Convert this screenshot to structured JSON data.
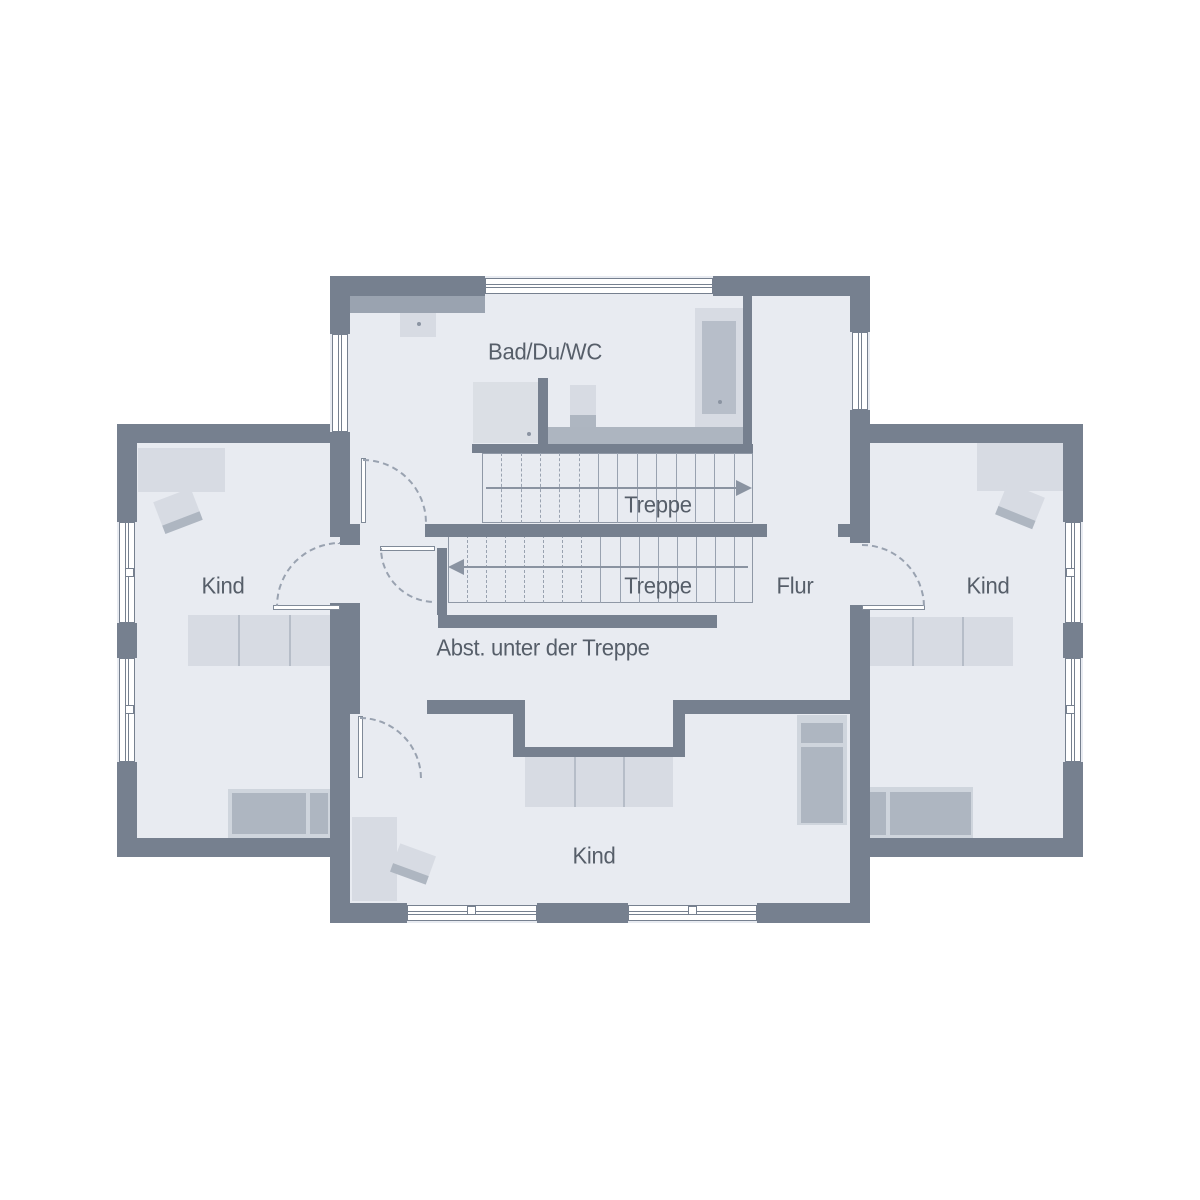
{
  "colors": {
    "wall": "#76808F",
    "floor": "#E8EBF1",
    "light": "#D7DBE3",
    "mid": "#AEB6C1",
    "lightmid": "#CFD5DD",
    "ledge": "#9AA3B0",
    "band": "#ADB5C0",
    "shower": "#DBDFE5",
    "tubinner": "#B7BEC9",
    "line": "#99A2B0",
    "accent": "#8A93A1",
    "text": "#565E69",
    "divider": "#B6BDC8"
  },
  "labels": [
    {
      "id": "bad",
      "text": "Bad/Du/WC",
      "x": 545,
      "y": 352
    },
    {
      "id": "treppe-upper",
      "text": "Treppe",
      "x": 658,
      "y": 505
    },
    {
      "id": "treppe-lower",
      "text": "Treppe",
      "x": 658,
      "y": 586
    },
    {
      "id": "flur",
      "text": "Flur",
      "x": 795,
      "y": 586
    },
    {
      "id": "kind-left",
      "text": "Kind",
      "x": 223,
      "y": 586
    },
    {
      "id": "kind-right",
      "text": "Kind",
      "x": 988,
      "y": 586
    },
    {
      "id": "kind-bottom",
      "text": "Kind",
      "x": 594,
      "y": 856
    },
    {
      "id": "abst",
      "text": "Abst. unter der Treppe",
      "x": 543,
      "y": 648
    }
  ],
  "floors": [
    {
      "n": "floor-center",
      "x": 330,
      "y": 276,
      "w": 540,
      "h": 647
    },
    {
      "n": "floor-left-wing",
      "x": 117,
      "y": 424,
      "w": 213,
      "h": 433
    },
    {
      "n": "floor-right-wing",
      "x": 870,
      "y": 424,
      "w": 213,
      "h": 433
    }
  ],
  "furniture": [
    {
      "n": "wardrobe-left",
      "x": 138,
      "y": 448,
      "w": 87,
      "h": 44,
      "c": "light"
    },
    {
      "n": "dresser-left",
      "x": 188,
      "y": 615,
      "w": 152,
      "h": 51,
      "c": "light"
    },
    {
      "n": "dresser-left-div-1",
      "x": 238,
      "y": 615,
      "w": 2,
      "h": 51,
      "c": "divider"
    },
    {
      "n": "dresser-left-div-2",
      "x": 289,
      "y": 615,
      "w": 2,
      "h": 51,
      "c": "divider"
    },
    {
      "n": "bed-left-base",
      "x": 228,
      "y": 789,
      "w": 104,
      "h": 49,
      "c": "lightmid"
    },
    {
      "n": "bed-left-mattress",
      "x": 232,
      "y": 793,
      "w": 74,
      "h": 41,
      "c": "mid"
    },
    {
      "n": "bed-left-pillow",
      "x": 310,
      "y": 793,
      "w": 18,
      "h": 41,
      "c": "mid"
    },
    {
      "n": "wardrobe-right",
      "x": 977,
      "y": 443,
      "w": 86,
      "h": 48,
      "c": "light"
    },
    {
      "n": "dresser-right",
      "x": 862,
      "y": 617,
      "w": 151,
      "h": 49,
      "c": "light"
    },
    {
      "n": "dresser-right-div-1",
      "x": 912,
      "y": 617,
      "w": 2,
      "h": 49,
      "c": "divider"
    },
    {
      "n": "dresser-right-div-2",
      "x": 962,
      "y": 617,
      "w": 2,
      "h": 49,
      "c": "divider"
    },
    {
      "n": "bed-right-base",
      "x": 860,
      "y": 787,
      "w": 113,
      "h": 51,
      "c": "lightmid"
    },
    {
      "n": "bed-right-pillow",
      "x": 864,
      "y": 792,
      "w": 22,
      "h": 43,
      "c": "mid"
    },
    {
      "n": "bed-right-mattress",
      "x": 890,
      "y": 792,
      "w": 81,
      "h": 43,
      "c": "mid"
    },
    {
      "n": "dresser-bottom",
      "x": 525,
      "y": 757,
      "w": 148,
      "h": 50,
      "c": "light"
    },
    {
      "n": "dresser-bottom-div-1",
      "x": 574,
      "y": 757,
      "w": 2,
      "h": 50,
      "c": "divider"
    },
    {
      "n": "dresser-bottom-div-2",
      "x": 623,
      "y": 757,
      "w": 2,
      "h": 50,
      "c": "divider"
    },
    {
      "n": "bed-bottom-base",
      "x": 797,
      "y": 715,
      "w": 50,
      "h": 110,
      "c": "lightmid"
    },
    {
      "n": "bed-bottom-pillow",
      "x": 801,
      "y": 723,
      "w": 42,
      "h": 20,
      "c": "mid"
    },
    {
      "n": "bed-bottom-mattress",
      "x": 801,
      "y": 747,
      "w": 42,
      "h": 76,
      "c": "mid"
    },
    {
      "n": "wardrobe-bottom",
      "x": 352,
      "y": 817,
      "w": 45,
      "h": 84,
      "c": "light"
    },
    {
      "n": "bath-ledge",
      "x": 350,
      "y": 296,
      "w": 135,
      "h": 17,
      "c": "ledge"
    },
    {
      "n": "sink",
      "x": 400,
      "y": 313,
      "w": 36,
      "h": 24,
      "c": "light"
    },
    {
      "n": "shower",
      "x": 473,
      "y": 382,
      "w": 65,
      "h": 61,
      "c": "shower"
    },
    {
      "n": "wc-tank",
      "x": 570,
      "y": 385,
      "w": 26,
      "h": 30,
      "c": "light"
    },
    {
      "n": "wc-base",
      "x": 570,
      "y": 415,
      "w": 26,
      "h": 13,
      "c": "mid"
    },
    {
      "n": "bathtub-surround",
      "x": 695,
      "y": 308,
      "w": 48,
      "h": 136,
      "c": "light"
    },
    {
      "n": "bathtub-inner",
      "x": 702,
      "y": 321,
      "w": 34,
      "h": 93,
      "c": "tubinner"
    },
    {
      "n": "bath-band",
      "x": 548,
      "y": 427,
      "w": 195,
      "h": 17,
      "c": "band"
    }
  ],
  "desks": [
    {
      "n": "desk-left",
      "x": 158,
      "y": 494,
      "w": 40,
      "h": 34,
      "rot": -21
    },
    {
      "n": "desk-right",
      "x": 1000,
      "y": 489,
      "w": 40,
      "h": 34,
      "rot": 22
    },
    {
      "n": "desk-bottom",
      "x": 394,
      "y": 849,
      "w": 38,
      "h": 30,
      "rot": 20
    }
  ],
  "walls": [
    [
      330,
      276,
      155,
      20
    ],
    [
      713,
      276,
      157,
      20
    ],
    [
      330,
      296,
      20,
      38
    ],
    [
      330,
      432,
      20,
      105
    ],
    [
      330,
      603,
      20,
      320
    ],
    [
      850,
      296,
      20,
      36
    ],
    [
      850,
      410,
      20,
      133
    ],
    [
      850,
      605,
      20,
      318
    ],
    [
      330,
      903,
      77,
      20
    ],
    [
      537,
      903,
      91,
      20
    ],
    [
      757,
      903,
      113,
      20
    ],
    [
      117,
      424,
      213,
      19
    ],
    [
      117,
      424,
      20,
      98
    ],
    [
      117,
      623,
      20,
      35
    ],
    [
      117,
      762,
      20,
      95
    ],
    [
      117,
      838,
      213,
      19
    ],
    [
      870,
      424,
      213,
      19
    ],
    [
      1063,
      424,
      20,
      98
    ],
    [
      1063,
      623,
      20,
      35
    ],
    [
      1063,
      762,
      20,
      95
    ],
    [
      870,
      838,
      213,
      19
    ],
    [
      472,
      444,
      281,
      9
    ],
    [
      743,
      296,
      9,
      148
    ],
    [
      538,
      378,
      10,
      66
    ],
    [
      425,
      524,
      342,
      13
    ],
    [
      838,
      524,
      12,
      13
    ],
    [
      340,
      524,
      20,
      21
    ],
    [
      437,
      548,
      10,
      67
    ],
    [
      438,
      615,
      279,
      13
    ],
    [
      340,
      603,
      20,
      111
    ],
    [
      427,
      700,
      98,
      14
    ],
    [
      673,
      700,
      177,
      14
    ],
    [
      513,
      700,
      12,
      57
    ],
    [
      673,
      700,
      12,
      57
    ],
    [
      513,
      747,
      172,
      10
    ]
  ],
  "windows": [
    {
      "n": "window-top",
      "x": 485,
      "y": 278,
      "w": 228,
      "h": 16,
      "o": "h",
      "handle": "none"
    },
    {
      "n": "window-bath-left",
      "x": 332,
      "y": 334,
      "w": 16,
      "h": 98,
      "o": "v",
      "handle": "none"
    },
    {
      "n": "window-flur-right",
      "x": 852,
      "y": 332,
      "w": 16,
      "h": 78,
      "o": "v",
      "handle": "none"
    },
    {
      "n": "window-bottom-1",
      "x": 407,
      "y": 905,
      "w": 130,
      "h": 16,
      "o": "h",
      "handle": "top"
    },
    {
      "n": "window-bottom-2",
      "x": 628,
      "y": 905,
      "w": 129,
      "h": 16,
      "o": "h",
      "handle": "top"
    },
    {
      "n": "window-left-wing-1",
      "x": 119,
      "y": 522,
      "w": 16,
      "h": 101,
      "o": "v",
      "handle": "right"
    },
    {
      "n": "window-left-wing-2",
      "x": 119,
      "y": 658,
      "w": 16,
      "h": 104,
      "o": "v",
      "handle": "right"
    },
    {
      "n": "window-right-wing-1",
      "x": 1065,
      "y": 522,
      "w": 16,
      "h": 101,
      "o": "v",
      "handle": "left"
    },
    {
      "n": "window-right-wing-2",
      "x": 1065,
      "y": 658,
      "w": 16,
      "h": 104,
      "o": "v",
      "handle": "left"
    }
  ],
  "doors": [
    {
      "n": "door-bath",
      "leaf": [
        361,
        458,
        5,
        65
      ],
      "box": [
        363,
        459,
        64
      ],
      "corner": "tr"
    },
    {
      "n": "door-abst",
      "leaf": [
        380,
        546,
        55,
        5
      ],
      "box": [
        380,
        548,
        55
      ],
      "corner": "bl"
    },
    {
      "n": "door-kind-left",
      "leaf": [
        273,
        605,
        67,
        5
      ],
      "box": [
        276,
        542,
        64
      ],
      "corner": "tl"
    },
    {
      "n": "door-kind-right",
      "leaf": [
        862,
        605,
        63,
        5
      ],
      "box": [
        862,
        544,
        63
      ],
      "corner": "tr"
    },
    {
      "n": "door-kind-bottom",
      "leaf": [
        358,
        716,
        5,
        62
      ],
      "box": [
        360,
        717,
        62
      ],
      "corner": "tr"
    }
  ],
  "stairs": [
    {
      "n": "stair-upper",
      "x": 482,
      "y": 453,
      "w": 271,
      "h": 70,
      "treads": [
        {
          "x": 501,
          "d": 1
        },
        {
          "x": 521,
          "d": 1
        },
        {
          "x": 540,
          "d": 1
        },
        {
          "x": 559,
          "d": 1
        },
        {
          "x": 579,
          "d": 1
        },
        {
          "x": 598,
          "d": 0
        },
        {
          "x": 617,
          "d": 0
        },
        {
          "x": 637,
          "d": 0
        },
        {
          "x": 656,
          "d": 0
        },
        {
          "x": 676,
          "d": 0
        },
        {
          "x": 695,
          "d": 0
        },
        {
          "x": 714,
          "d": 0
        },
        {
          "x": 734,
          "d": 0
        }
      ],
      "arrow": {
        "y": 488,
        "x1": 486,
        "x2": 736,
        "dir": "right"
      }
    },
    {
      "n": "stair-lower",
      "x": 448,
      "y": 535,
      "w": 305,
      "h": 68,
      "treads": [
        {
          "x": 467,
          "d": 1
        },
        {
          "x": 486,
          "d": 1
        },
        {
          "x": 505,
          "d": 1
        },
        {
          "x": 524,
          "d": 1
        },
        {
          "x": 543,
          "d": 1
        },
        {
          "x": 562,
          "d": 1
        },
        {
          "x": 581,
          "d": 1
        },
        {
          "x": 600,
          "d": 0
        },
        {
          "x": 620,
          "d": 0
        },
        {
          "x": 639,
          "d": 0
        },
        {
          "x": 658,
          "d": 0
        },
        {
          "x": 677,
          "d": 0
        },
        {
          "x": 696,
          "d": 0
        },
        {
          "x": 715,
          "d": 0
        },
        {
          "x": 734,
          "d": 0
        }
      ],
      "arrow": {
        "y": 567,
        "x1": 464,
        "x2": 748,
        "dir": "left"
      }
    }
  ],
  "dots": [
    {
      "n": "sink-drain-dot",
      "x": 417,
      "y": 322
    },
    {
      "n": "shower-drain-dot",
      "x": 527,
      "y": 432
    },
    {
      "n": "bathtub-drain-dot",
      "x": 718,
      "y": 400
    }
  ]
}
